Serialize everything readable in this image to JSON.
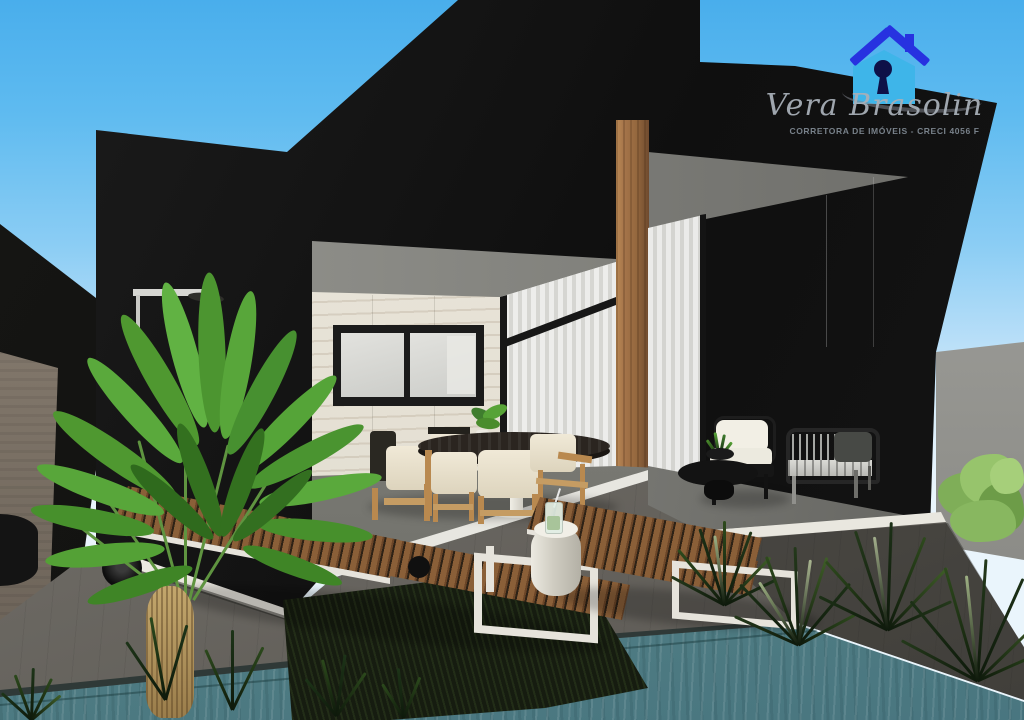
{
  "watermark": {
    "brand_name": "Vera Brasolin",
    "tagline": "CORRETORA DE IMÓVEIS - CRECI 4056 F",
    "icon": "house-keyhole-logo-icon"
  },
  "palette": {
    "sky_top": "#49aeec",
    "sky_horizon": "#dceffb",
    "house_black": "#141414",
    "marble_wall": "#ece8dd",
    "wood_column": "#96693f",
    "boundary_wall": "#a8a8a4",
    "deck_gray": "#6e6b65",
    "step_white": "#ece9e1",
    "pool_coping": "#2f3937",
    "pool_water": "#5d8a88",
    "planting_bed": "#161c10",
    "chair_wood": "#b9894f",
    "lounger_frame": "#e6e3db",
    "foliage_green": "#57a337",
    "bush_green": "#8cb562",
    "logo_roof_blue": "#2732e0",
    "logo_body_blue": "#3eb5e9",
    "logo_keyhole_navy": "#0e1148"
  }
}
